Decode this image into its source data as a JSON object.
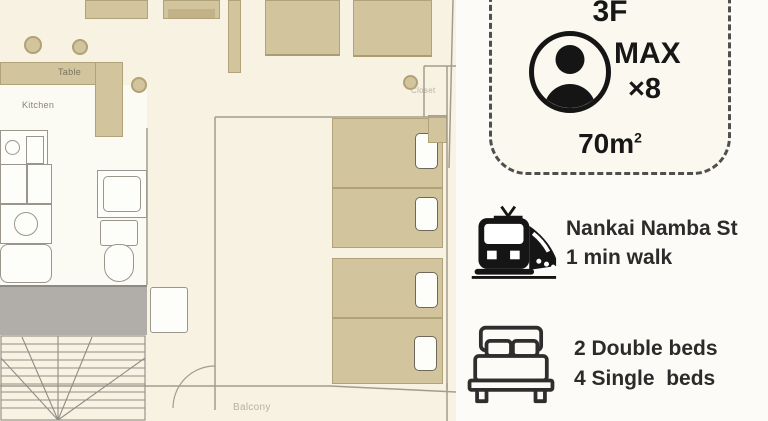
{
  "floor_plan": {
    "table_label": "Table",
    "kitchen_label": "Kitchen",
    "closet_label": "Closet",
    "balcony_label": "Balcony"
  },
  "info_panel": {
    "badge": {
      "floor": "3F",
      "max_label": "MAX",
      "max_multiplier": "×8",
      "area_value": "70m",
      "area_superscript": "2"
    },
    "station": {
      "name": "Nankai Namba St",
      "walk_time": "1 min walk"
    },
    "bedding": {
      "double_beds": "2 Double beds",
      "single_beds": "4 Single  beds"
    }
  },
  "icons": {
    "person": "person-icon",
    "train": "train-icon",
    "bed": "bed-icon"
  },
  "colors": {
    "plan_background": "#f7f2e2",
    "furniture_tan": "#d2c49c",
    "panel_background": "#fcfbf7",
    "badge_background": "#faf8ef",
    "badge_border": "#4f4f4f",
    "corridor_gray": "#b1aeaa",
    "text_dark": "#262626"
  }
}
